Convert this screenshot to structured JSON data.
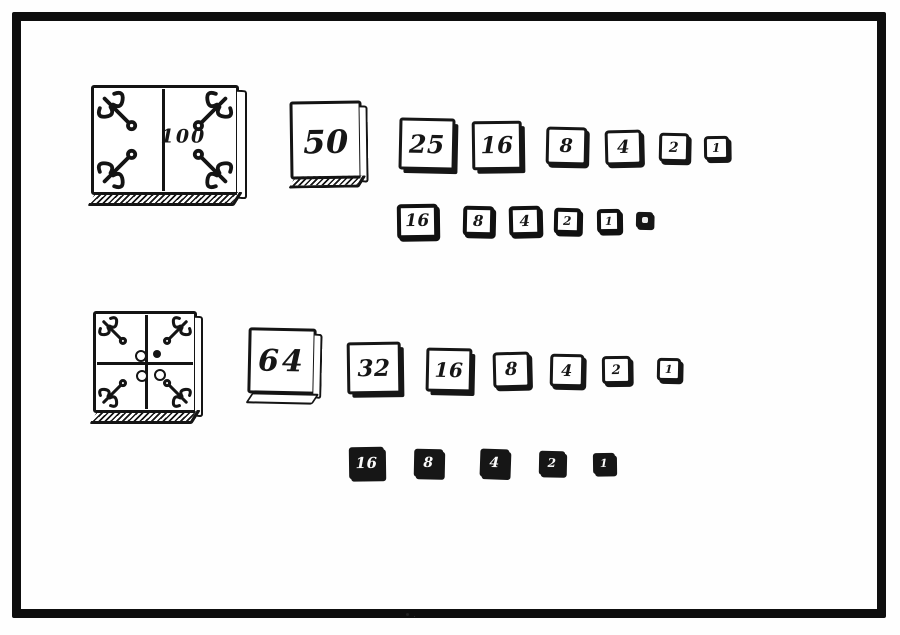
{
  "palette": {
    "paper": "#fefefe",
    "ink": "#141414",
    "frame_border": "#0e0e0e"
  },
  "figure": {
    "kind": "woodcut-weights-plate",
    "groups": 2
  },
  "top_group": {
    "large_block": {
      "label": "100",
      "divided": "vertical-halves",
      "ornament_icon": "corner-flourish-icon",
      "ornament_count": 4
    },
    "row1": [
      "50",
      "25",
      "16",
      "8",
      "4",
      "2",
      "1"
    ],
    "row2": [
      "16",
      "8",
      "4",
      "2",
      "1",
      ""
    ]
  },
  "bottom_group": {
    "large_block": {
      "label": "",
      "divided": "quadrants",
      "ornament_icon": "corner-flourish-icon",
      "ornament_count": 4,
      "dots": [
        "open",
        "filled",
        "open",
        "open"
      ]
    },
    "row1": [
      "64",
      "32",
      "16",
      "8",
      "4",
      "2",
      "1"
    ],
    "row2": [
      "16",
      "8",
      "4",
      "2",
      "1"
    ]
  }
}
